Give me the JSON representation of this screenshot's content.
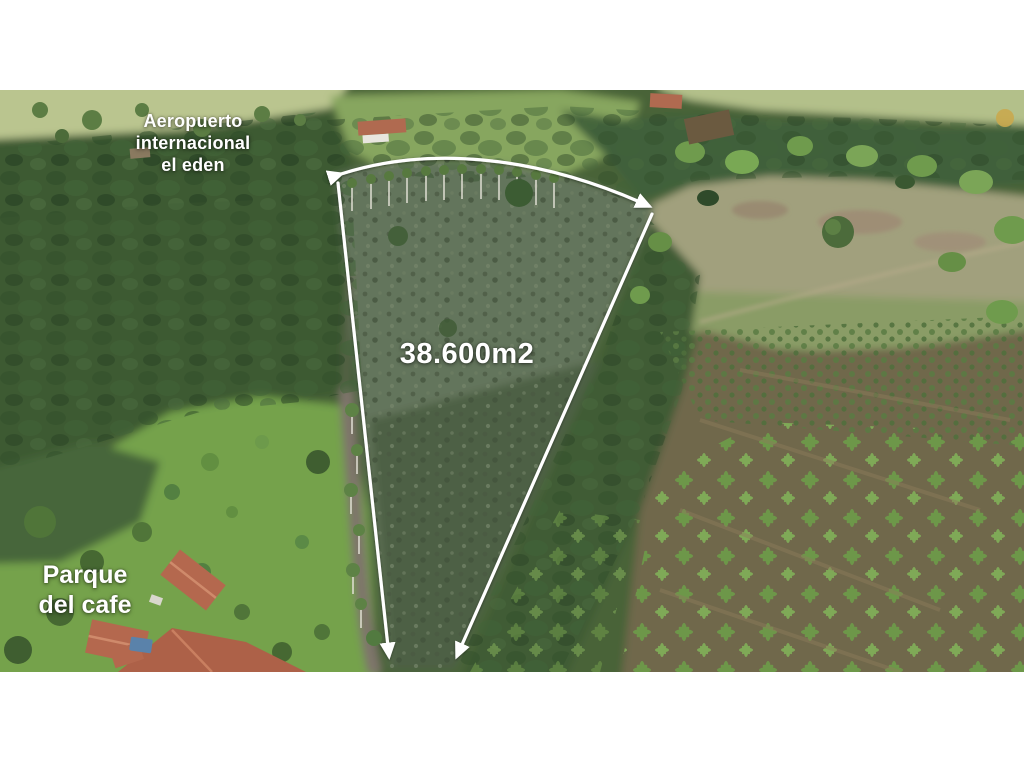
{
  "photo": {
    "alt": "aerial-drone-photo-of-rural-land-parcel",
    "labels": {
      "airport": {
        "line1": "Aeropuerto",
        "line2": "internacional",
        "line3": "el eden"
      },
      "area": "38.600m2",
      "park": {
        "line1": "Parque",
        "line2": "del cafe"
      }
    },
    "annotation": {
      "name": "property-boundary-wedge",
      "color": "#ffffff"
    },
    "colors": {
      "letterbox": "#ffffff",
      "overlay_text": "#ffffff",
      "pasture_light": "#bac58f",
      "pasture_right": "#a1a07d",
      "forest_dark": "#3e5a33",
      "parcel_scrub": "#64755c",
      "plantation_soil": "#6f684c",
      "lawn_green": "#74a24c",
      "roof_terracotta": "#b4684e",
      "road_gray": "#7e756a",
      "pool_blue": "#5a82aa",
      "bamboo_bright": "#6f9b4d"
    }
  }
}
